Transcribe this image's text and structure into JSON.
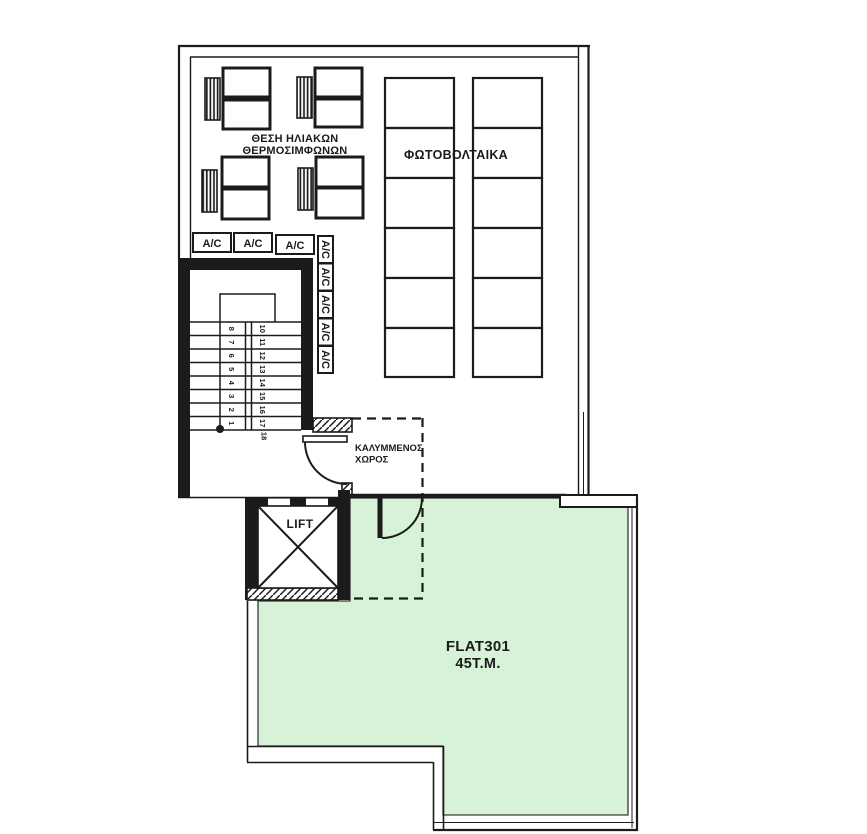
{
  "labels": {
    "solar_line1": "ΘΕΣΗ ΗΛΙΑΚΩΝ",
    "solar_line2": "ΘΕΡΜΟΣΙΜΦΩΝΩΝ",
    "pv": "ΦΩΤΟΒΟΛΤΑΙΚΑ",
    "ac": "A/C",
    "lift": "LIFT",
    "covered_line1": "ΚΑΛΥΜΜΕΝΟΣ",
    "covered_line2": "ΧΩΡΟΣ",
    "flat_name": "FLAT301",
    "flat_area": "45T.M."
  },
  "stairs": {
    "left_flight": [
      "1",
      "2",
      "3",
      "4",
      "5",
      "6",
      "7",
      "8"
    ],
    "right_flight": [
      "10",
      "11",
      "12",
      "13",
      "14",
      "15",
      "16",
      "17"
    ],
    "landing_step": "18"
  },
  "colors": {
    "terrace_green": "#d7f2d6",
    "line_black": "#1b1b1b"
  }
}
